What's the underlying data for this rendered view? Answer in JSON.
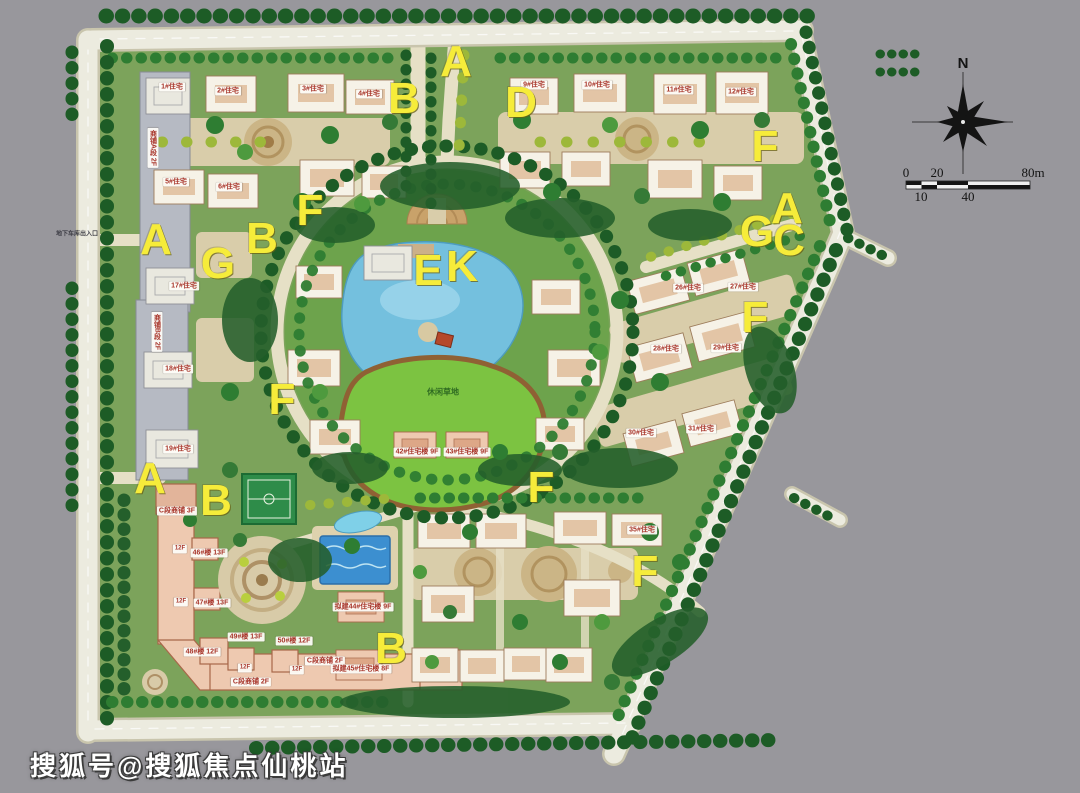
{
  "map": {
    "type": "residential-community-master-plan",
    "colors": {
      "background": "#98979c",
      "road": "#ecebdf",
      "site_green": "#7ca35b",
      "tree_dark": "#1d5c26",
      "lake": "#74c0de",
      "lawn": "#7cc341",
      "paving": "#d9cdaa",
      "pool": "#3c8fd0",
      "court": "#2e8c49",
      "letter_yellow": "#f6ec3a",
      "c_building_salmon": "#eec9b0"
    }
  },
  "letters": [
    "A",
    "B",
    "D",
    "F",
    "A",
    "G",
    "C",
    "A",
    "B",
    "G",
    "F",
    "E",
    "K",
    "F",
    "F",
    "A",
    "B",
    "F",
    "F",
    "B"
  ],
  "chips": [
    {
      "text": "1#住宅"
    },
    {
      "text": "2#住宅"
    },
    {
      "text": "3#住宅"
    },
    {
      "text": "4#住宅"
    },
    {
      "text": "5#住宅"
    },
    {
      "text": "6#住宅"
    },
    {
      "text": "9#住宅"
    },
    {
      "text": "10#住宅"
    },
    {
      "text": "11#住宅"
    },
    {
      "text": "12#住宅"
    },
    {
      "text": "17#住宅"
    },
    {
      "text": "18#住宅"
    },
    {
      "text": "19#住宅"
    },
    {
      "text": "26#住宅"
    },
    {
      "text": "27#住宅"
    },
    {
      "text": "28#住宅"
    },
    {
      "text": "29#住宅"
    },
    {
      "text": "30#住宅"
    },
    {
      "text": "31#住宅"
    },
    {
      "text": "35#住宅"
    },
    {
      "text": "42#住宅楼 9F"
    },
    {
      "text": "43#住宅楼 9F"
    },
    {
      "text": "商铺A段 2F"
    },
    {
      "text": "商铺B段 2F"
    },
    {
      "text": "C段商铺 3F"
    },
    {
      "text": "12F"
    },
    {
      "text": "46#楼 13F"
    },
    {
      "text": "12F"
    },
    {
      "text": "47#楼 13F"
    },
    {
      "text": "48#楼 12F"
    },
    {
      "text": "49#楼 13F"
    },
    {
      "text": "50#楼 12F"
    },
    {
      "text": "12F"
    },
    {
      "text": "12F"
    },
    {
      "text": "C段商铺 2F"
    },
    {
      "text": "C段商铺 2F"
    },
    {
      "text": "拟建44#住宅楼 9F"
    },
    {
      "text": "拟建45#住宅楼 8F"
    },
    {
      "text": "休闲草地"
    },
    {
      "text": "地下车库出入口"
    }
  ],
  "compass": {
    "north": "N"
  },
  "scale_bar": {
    "t0": "0",
    "t20": "20",
    "t80": "80m",
    "t10": "10",
    "t40": "40"
  },
  "watermark": {
    "text": "搜狐号@搜狐焦点仙桃站"
  }
}
